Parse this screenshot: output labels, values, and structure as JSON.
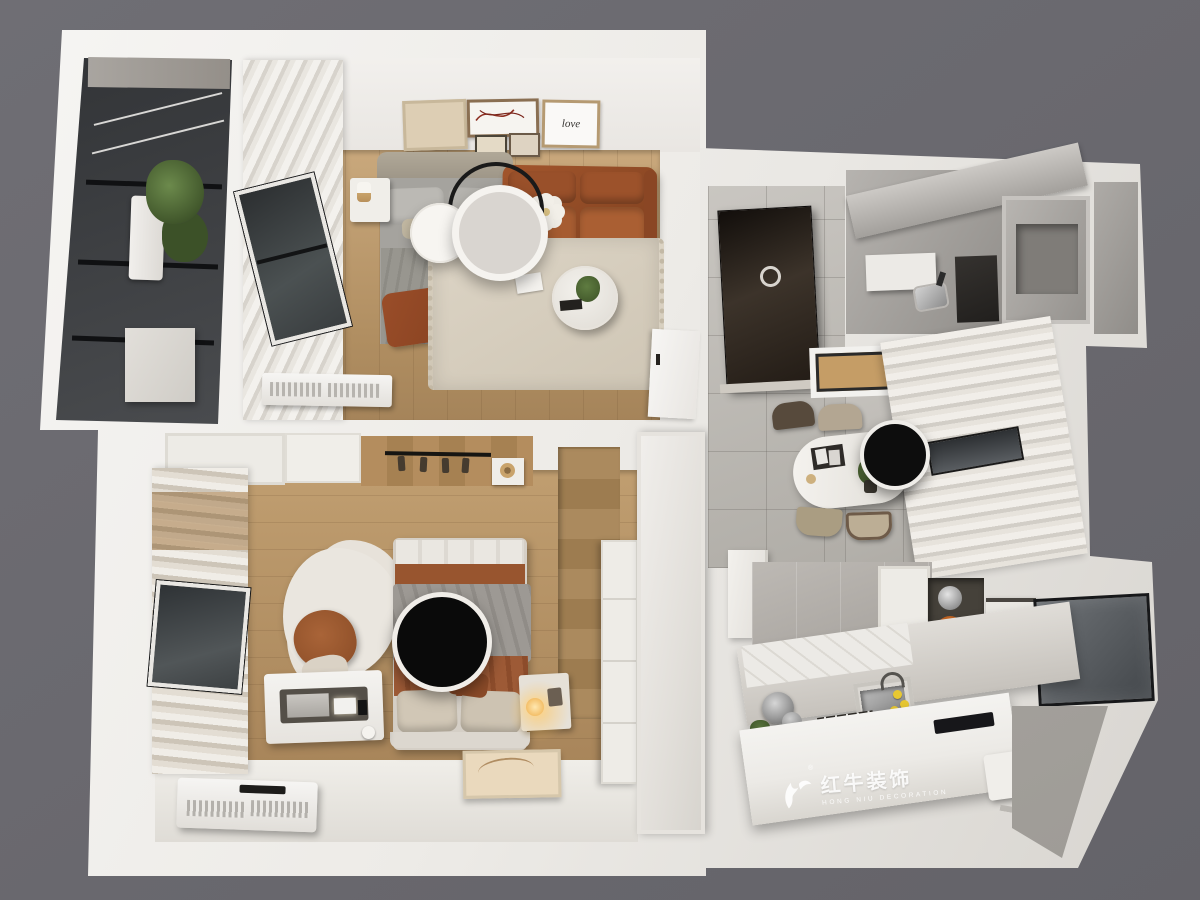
{
  "watermark": {
    "logo_icon": "bull-swoosh-icon",
    "registered_mark": "®",
    "brand_cn": "红牛装饰",
    "brand_en": "HONG NIU DECORATION"
  },
  "decor": {
    "love_frame_text": "love"
  },
  "palette": {
    "background_gray": "#6A696F",
    "outer_wall_white": "#F1EFEB",
    "wood_floor_light": "#C9A87C",
    "wood_floor_deep": "#A8855A",
    "terracotta_sofa": "#A2552C",
    "terracotta_textile": "#98552F",
    "marble_gray": "#AFACA8",
    "hall_tile_gray": "#C0BDB8",
    "glass_dark": "#3A3E42",
    "fixture_black": "#0D0D0D",
    "brass_accent": "#C9A36B",
    "plant_green": "#4C6530",
    "lemon_yellow": "#E8C832",
    "lamp_glow": "#FFC662",
    "watermark_white": "#FFFFFF"
  }
}
